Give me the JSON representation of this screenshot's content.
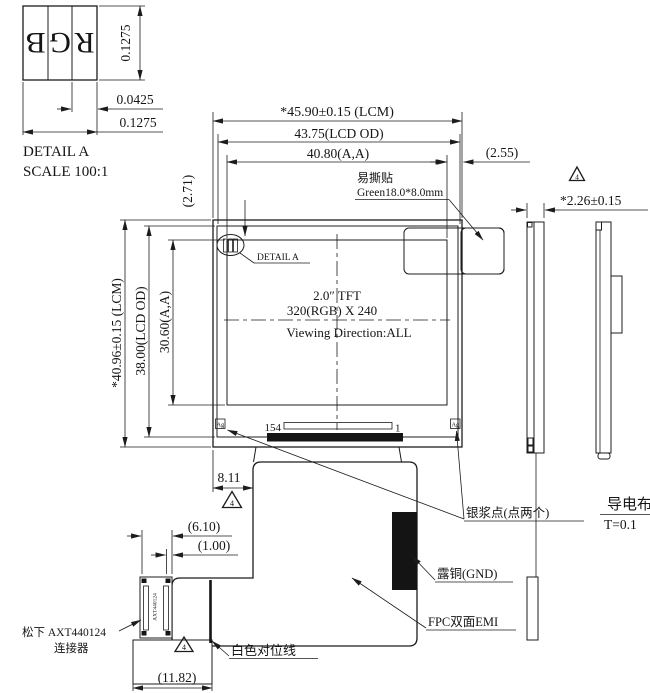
{
  "title_block": {
    "detail_label": "DETAIL A",
    "scale_label": "SCALE 100:1"
  },
  "detail_a": {
    "cells": [
      "B",
      "G",
      "R"
    ],
    "dim_cell_height": "0.1275",
    "dim_subpixel": "0.0425",
    "dim_pixel": "0.1275"
  },
  "dimensions": {
    "width_lcm": "*45.90±0.15 (LCM)",
    "width_lcd": "43.75(LCD OD)",
    "width_aa": "40.80(A,A)",
    "margin_right": "(2.55)",
    "margin_top": "(2.71)",
    "height_lcm": "*40.96±0.15 (LCM)",
    "height_lcd": "38.00(LCD OD)",
    "height_aa": "30.60(A,A)",
    "thickness": "*2.26±0.15",
    "fpc_offset": "8.11",
    "connector_offset": "(6.10)",
    "connector_pitch": "(1.00)",
    "tail_width": "(11.82)"
  },
  "panel": {
    "size_line": "2.0″ TFT",
    "resolution_line": "320(RGB) X 240",
    "viewing_line": "Viewing Direction:ALL",
    "pin_first": "154",
    "pin_last": "1",
    "silver_dot": "Ag"
  },
  "annotations": {
    "sticker_name": "易撕贴",
    "sticker_spec": "Green18.0*8.0mm",
    "detail_callout": "DETAIL A",
    "silver_paste": "银浆点(点两个)",
    "exposed_copper": "露铜(GND)",
    "fpc_emi": "FPC双面EMI",
    "white_align_line": "白色对位线",
    "connector_brand": "松下 AXT440124",
    "connector_word": "连接器",
    "connector_part": "AXT440124",
    "conductive_cloth": "导电布",
    "conductive_thickness": "T=0.1",
    "rev_triangle": "4"
  }
}
